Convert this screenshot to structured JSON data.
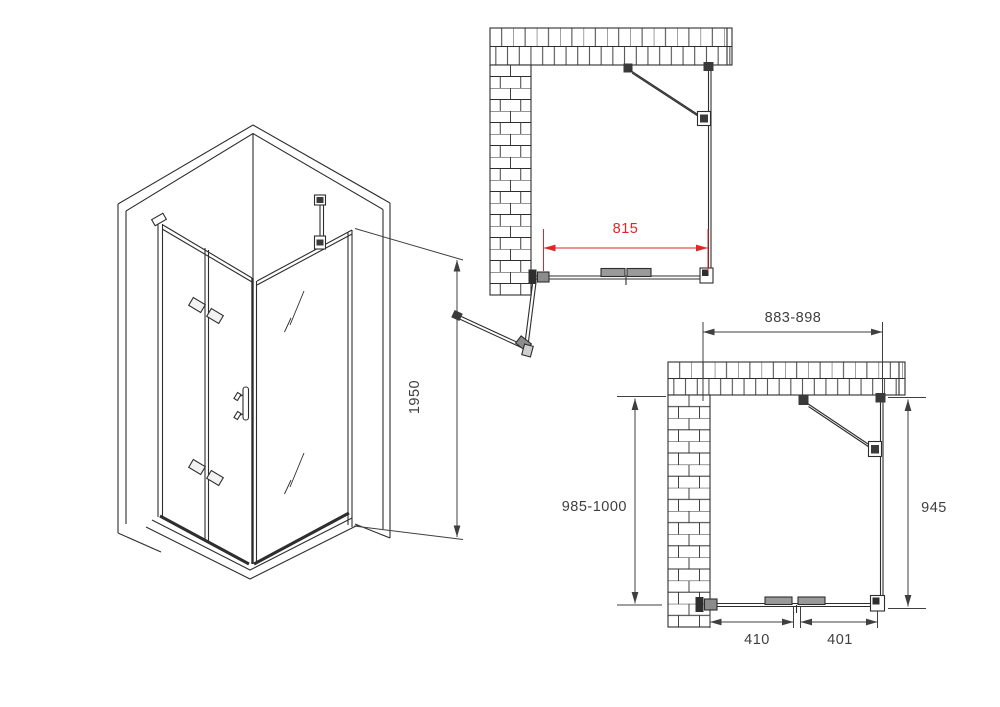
{
  "colors": {
    "line": "#2e2e2e",
    "text": "#3f3f3f",
    "accent_red": "#e02626",
    "hardware_gray": "#9a9a9a",
    "hardware_dark": "#3a3a3a",
    "background": "#ffffff"
  },
  "isometric_view": {
    "height_label": "1950"
  },
  "plan_view_open": {
    "opening_width_label": "815"
  },
  "plan_view_closed": {
    "overall_width_label": "883-898",
    "overall_depth_label": "985-1000",
    "side_panel_label": "945",
    "door_panel_label": "410",
    "fixed_panel_label": "401"
  }
}
